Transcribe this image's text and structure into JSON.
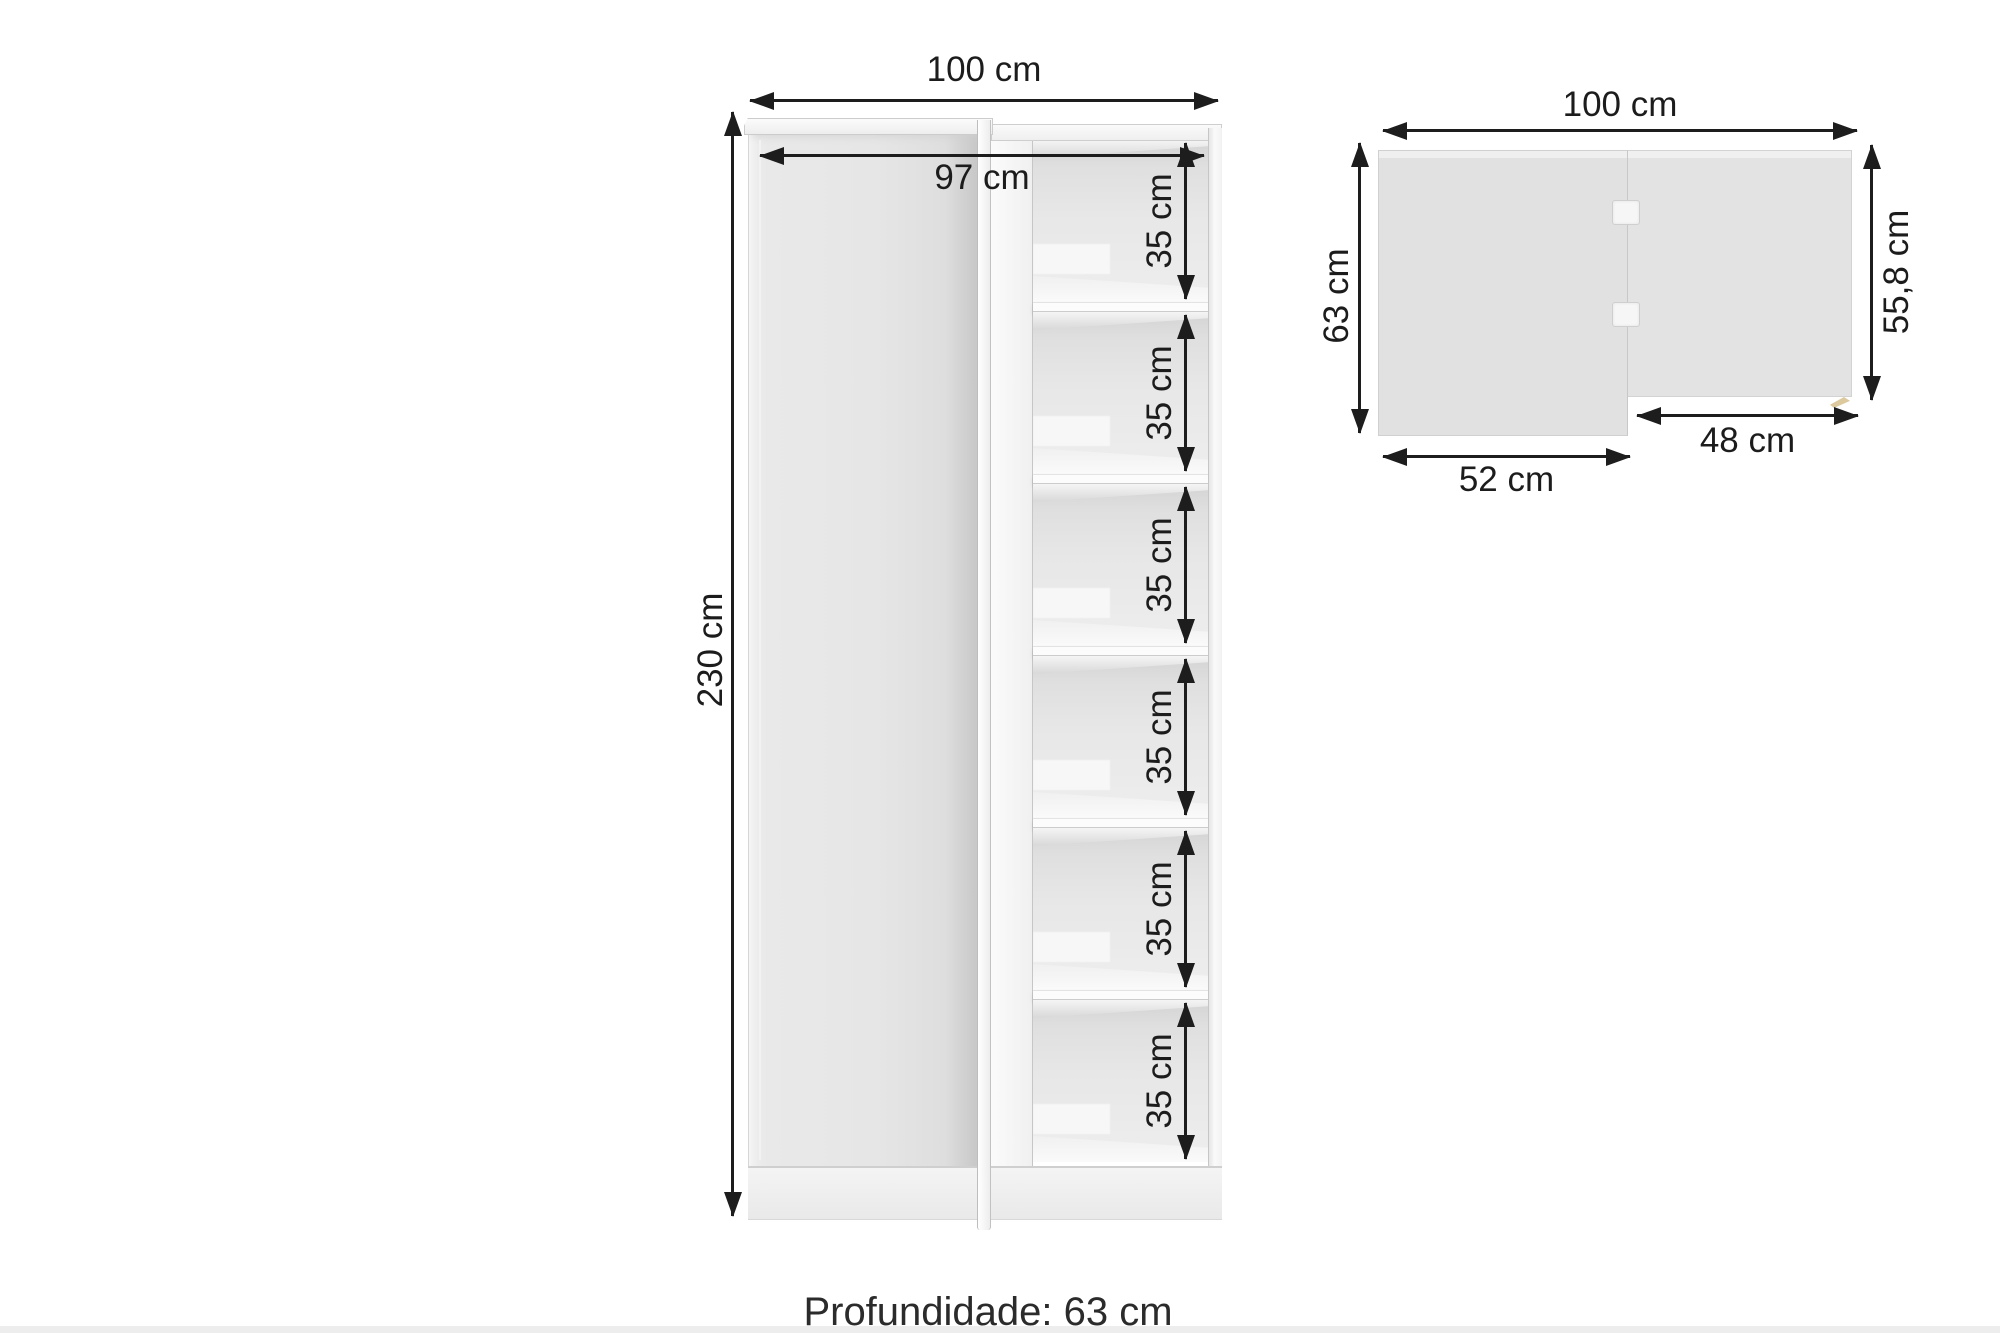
{
  "front_view": {
    "width_label": "100 cm",
    "inner_width_label": "97 cm",
    "height_label": "230 cm",
    "compartment_labels": [
      "35 cm",
      "35 cm",
      "35 cm",
      "35 cm",
      "35 cm",
      "35 cm"
    ],
    "compartment_count": 6,
    "shelf_count": 5
  },
  "top_view": {
    "width_label": "100 cm",
    "left_depth_label": "63 cm",
    "right_depth_label": "55,8 cm",
    "right_section_width_label": "48 cm",
    "left_section_width_label": "52 cm",
    "hinge_count": 2
  },
  "footer": {
    "depth_text": "Profundidade: 63 cm"
  },
  "dimensions_cm": {
    "width": 100,
    "inner_width": 97,
    "height": 230,
    "shelf_spacing": 35,
    "depth": 63,
    "right_depth": 55.8,
    "left_section_width": 52,
    "right_section_width": 48
  },
  "colors": {
    "annotation": "#1d1d1d",
    "panel_white": "#f6f6f6",
    "panel_gray": "#e1e1e1",
    "interior_gray": "#e7e7e7",
    "wood_accent": "#dcc99e",
    "background": "#ffffff"
  }
}
